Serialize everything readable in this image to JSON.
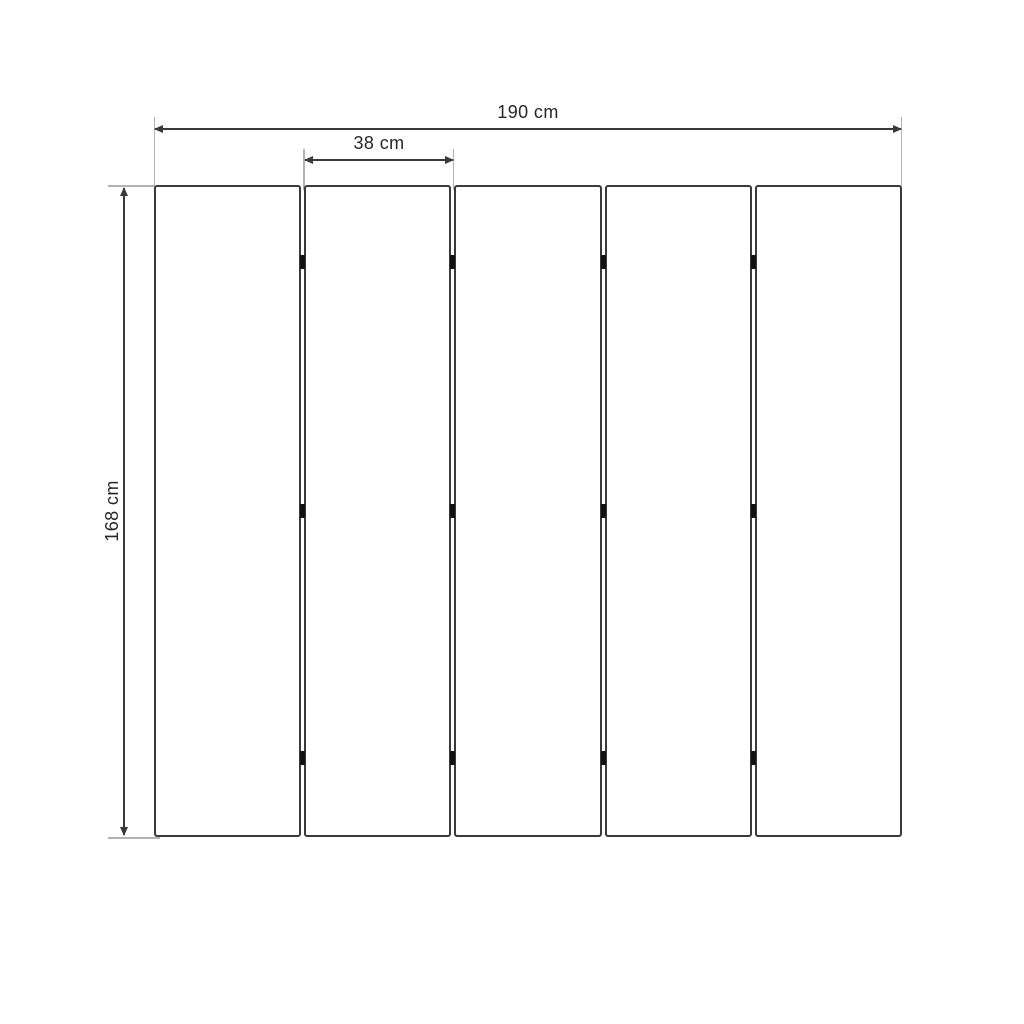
{
  "diagram": {
    "type": "dimension-drawing",
    "subject": "five-panel folding screen, front elevation",
    "panel_count": 5,
    "gap_count": 4,
    "hinge_marks_per_gap": 3,
    "dimensions": {
      "total_width": "190 cm",
      "panel_width": "38 cm",
      "height": "168 cm"
    },
    "colors": {
      "background": "#ffffff",
      "outline": "#3a3a3a",
      "extension_line": "#b3b3b3",
      "hinge": "#111111",
      "label_text": "#262626"
    }
  }
}
